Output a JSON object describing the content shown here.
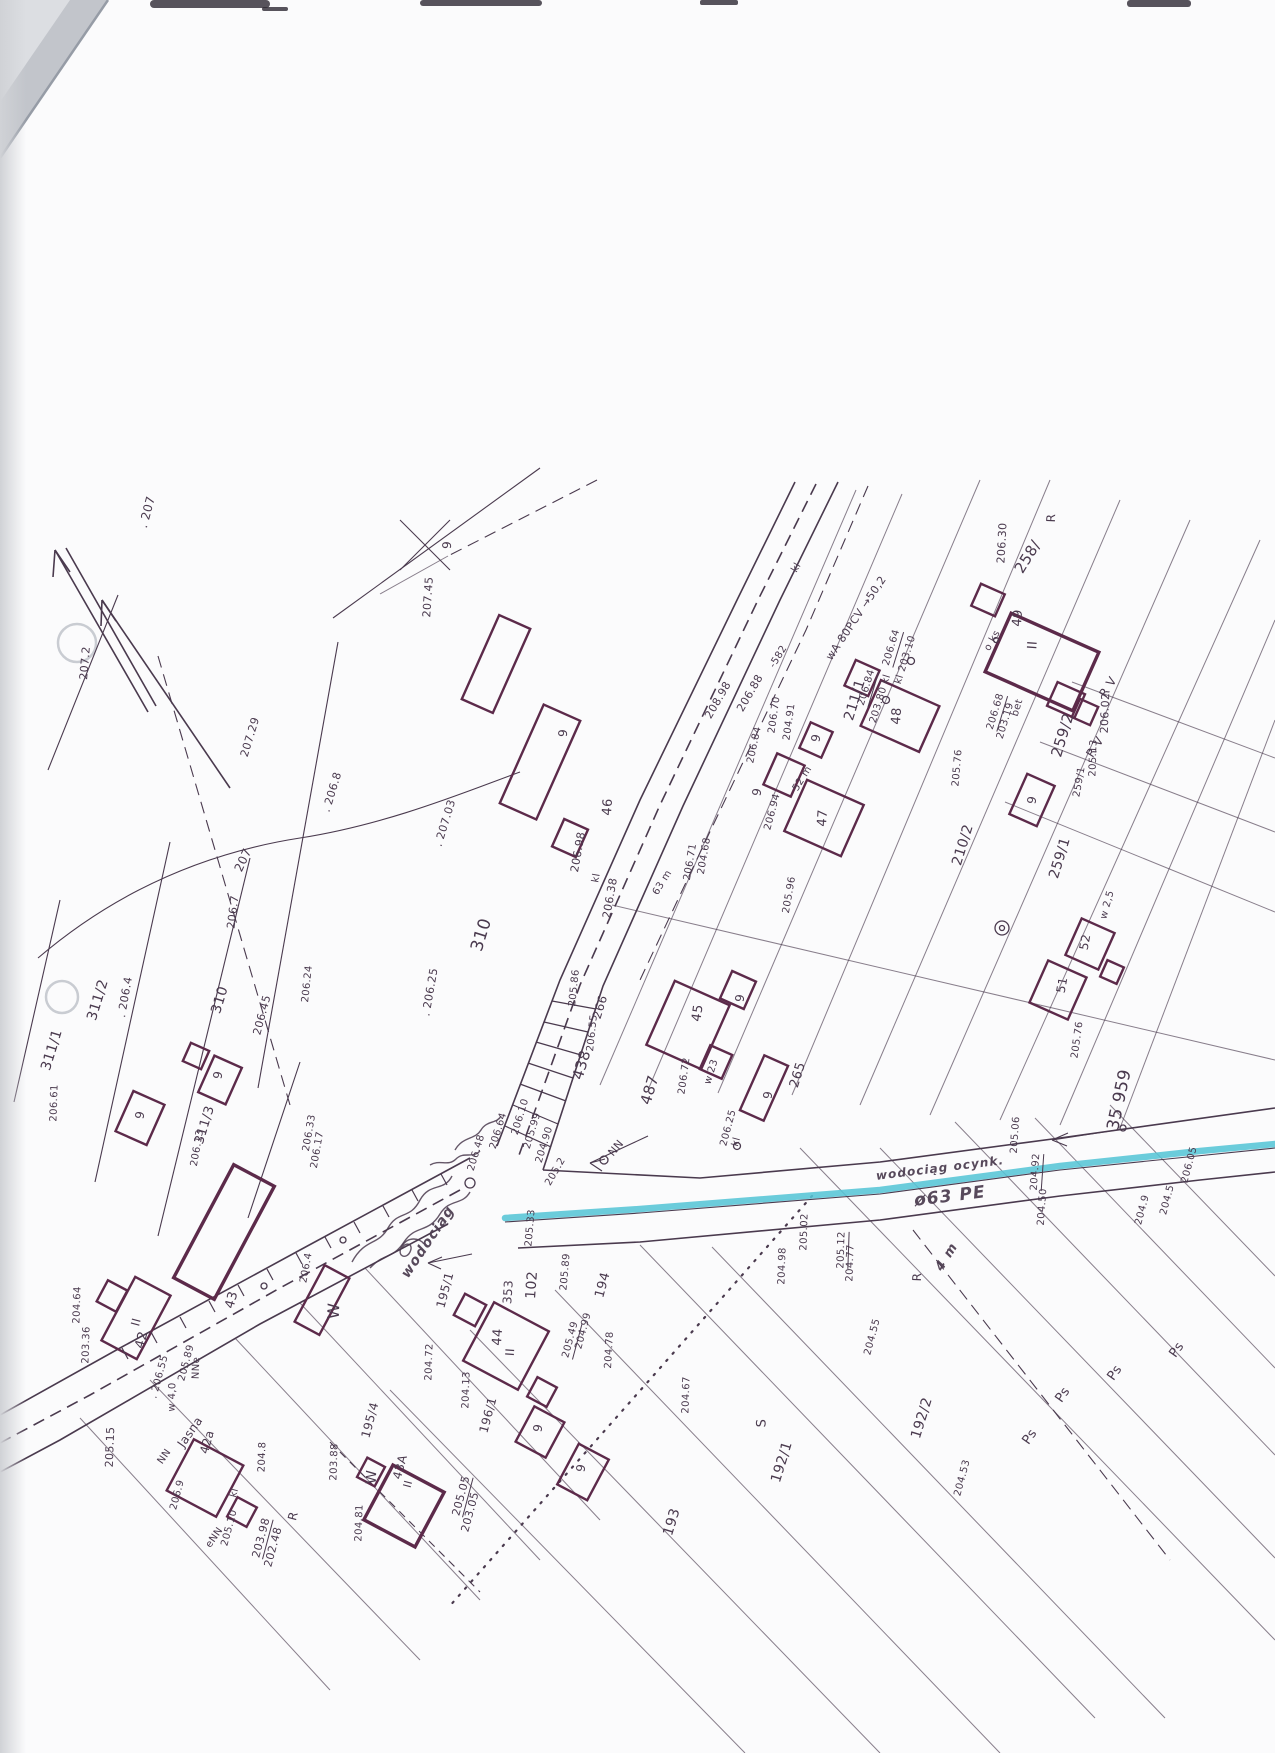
{
  "document": {
    "type": "scanned geodetic cadastral map sheet",
    "street": "Jasna"
  },
  "colors": {
    "paper": "#fbfbfc",
    "ink": "#4a3a4e",
    "ink_faint": "#8a7c90",
    "building": "#5c2a4a",
    "highlight": "#57c5d6",
    "edge_shadow": "#c9ccd1",
    "smudge": "#2e2933"
  },
  "map": {
    "labels": [
      {
        "t": ". 207",
        "x": 147,
        "y": 512,
        "r": -75,
        "s": 12
      },
      {
        "t": "207.2",
        "x": 85,
        "y": 663,
        "r": -85,
        "s": 11
      },
      {
        "t": "207.29",
        "x": 250,
        "y": 737,
        "r": -73,
        "s": 11
      },
      {
        "t": "207",
        "x": 243,
        "y": 860,
        "r": -65,
        "s": 12
      },
      {
        "t": ". 206.8",
        "x": 332,
        "y": 792,
        "r": -73,
        "s": 11
      },
      {
        "t": "206.7",
        "x": 233,
        "y": 912,
        "r": -83,
        "s": 11
      },
      {
        "t": "311/2",
        "x": 98,
        "y": 1000,
        "r": -73,
        "s": 14
      },
      {
        "t": "311/1",
        "x": 52,
        "y": 1050,
        "r": -73,
        "s": 14
      },
      {
        "t": ". 206.4",
        "x": 125,
        "y": 997,
        "r": -80,
        "s": 11
      },
      {
        "t": "310",
        "x": 220,
        "y": 1000,
        "r": -73,
        "s": 14
      },
      {
        "t": "206.45",
        "x": 262,
        "y": 1015,
        "r": -75,
        "s": 11
      },
      {
        "t": "310",
        "x": 482,
        "y": 935,
        "r": -73,
        "s": 17
      },
      {
        "t": ". 207.03",
        "x": 445,
        "y": 823,
        "r": -73,
        "s": 11
      },
      {
        "t": ". 206.25",
        "x": 430,
        "y": 992,
        "r": -80,
        "s": 11
      },
      {
        "t": "206.24",
        "x": 308,
        "y": 984,
        "r": -84,
        "s": 10
      },
      {
        "t": "207.45",
        "x": 428,
        "y": 597,
        "r": -86,
        "s": 11
      },
      {
        "t": "9",
        "x": 447,
        "y": 545,
        "r": -86,
        "s": 12
      },
      {
        "t": "206.98",
        "x": 578,
        "y": 852,
        "r": -80,
        "s": 11
      },
      {
        "t": "kl",
        "x": 597,
        "y": 878,
        "r": -80,
        "s": 10
      },
      {
        "t": "206.38",
        "x": 610,
        "y": 898,
        "r": -80,
        "s": 11
      },
      {
        "t": "9",
        "x": 563,
        "y": 733,
        "r": -86,
        "s": 12
      },
      {
        "t": "46",
        "x": 608,
        "y": 807,
        "r": -86,
        "s": 13
      },
      {
        "t": "208.98",
        "x": 718,
        "y": 700,
        "r": -60,
        "s": 11
      },
      {
        "t": "206.88",
        "x": 750,
        "y": 693,
        "r": -60,
        "s": 11
      },
      {
        "t": "-582",
        "x": 779,
        "y": 657,
        "r": -58,
        "s": 10
      },
      {
        "t": "206.84",
        "x": 755,
        "y": 745,
        "r": -78,
        "s": 10
      },
      {
        "t": "206.70",
        "x": 775,
        "y": 715,
        "r": -82,
        "s": 10
      },
      {
        "t": "204.91",
        "x": 790,
        "y": 722,
        "r": -82,
        "s": 10
      },
      {
        "t": "wA 80PCV →50,2",
        "x": 856,
        "y": 618,
        "r": -56,
        "s": 11
      },
      {
        "t": "kl",
        "x": 797,
        "y": 568,
        "r": -60,
        "s": 10
      },
      {
        "t": "206.94",
        "x": 773,
        "y": 812,
        "r": -75,
        "s": 10
      },
      {
        "t": "52 m",
        "x": 803,
        "y": 779,
        "r": -58,
        "s": 10
      },
      {
        "t": "47",
        "x": 823,
        "y": 818,
        "r": -86,
        "s": 13
      },
      {
        "t": "9",
        "x": 757,
        "y": 792,
        "r": -80,
        "s": 12
      },
      {
        "t": "9",
        "x": 816,
        "y": 738,
        "r": -80,
        "s": 12
      },
      {
        "t": "48",
        "x": 897,
        "y": 716,
        "r": -86,
        "s": 13
      },
      {
        "t": "206.84",
        "x": 868,
        "y": 688,
        "r": -73,
        "s": 10,
        "u": true
      },
      {
        "t": "203.80 kl",
        "x": 881,
        "y": 699,
        "r": -73,
        "s": 10
      },
      {
        "t": "206.64",
        "x": 893,
        "y": 648,
        "r": -73,
        "s": 10,
        "u": true
      },
      {
        "t": "kl 203.10",
        "x": 906,
        "y": 660,
        "r": -73,
        "s": 10
      },
      {
        "t": "o ks",
        "x": 993,
        "y": 641,
        "r": -60,
        "s": 10
      },
      {
        "t": "206.68",
        "x": 997,
        "y": 712,
        "r": -73,
        "s": 10,
        "u": true
      },
      {
        "t": "203.19",
        "x": 1006,
        "y": 721,
        "r": -73,
        "s": 10
      },
      {
        "t": "bet",
        "x": 1018,
        "y": 708,
        "r": -73,
        "s": 10
      },
      {
        "t": "49",
        "x": 1018,
        "y": 618,
        "r": -86,
        "s": 13
      },
      {
        "t": "II",
        "x": 1033,
        "y": 645,
        "r": -86,
        "s": 13
      },
      {
        "t": "258/",
        "x": 1028,
        "y": 557,
        "r": -58,
        "s": 15
      },
      {
        "t": "259/2",
        "x": 1063,
        "y": 735,
        "r": -73,
        "s": 15
      },
      {
        "t": "R V",
        "x": 1108,
        "y": 687,
        "r": -58,
        "s": 12
      },
      {
        "t": "R V",
        "x": 1095,
        "y": 747,
        "r": -58,
        "s": 12
      },
      {
        "t": "206.30",
        "x": 1002,
        "y": 543,
        "r": -87,
        "s": 11
      },
      {
        "t": "R",
        "x": 1051,
        "y": 518,
        "r": -88,
        "s": 12
      },
      {
        "t": "206.02",
        "x": 1105,
        "y": 713,
        "r": -88,
        "s": 11
      },
      {
        "t": "205.13",
        "x": 1094,
        "y": 758,
        "r": -88,
        "s": 10
      },
      {
        "t": "259/1",
        "x": 1080,
        "y": 782,
        "r": -80,
        "s": 10
      },
      {
        "t": "211/1",
        "x": 855,
        "y": 700,
        "r": -73,
        "s": 14
      },
      {
        "t": "210/2",
        "x": 963,
        "y": 845,
        "r": -73,
        "s": 14
      },
      {
        "t": "259/1",
        "x": 1060,
        "y": 858,
        "r": -73,
        "s": 14
      },
      {
        "t": "205.76",
        "x": 958,
        "y": 768,
        "r": -85,
        "s": 10
      },
      {
        "t": "9",
        "x": 1032,
        "y": 800,
        "r": -80,
        "s": 12
      },
      {
        "t": "205.96",
        "x": 790,
        "y": 895,
        "r": -80,
        "s": 10
      },
      {
        "t": "52",
        "x": 1085,
        "y": 942,
        "r": -80,
        "s": 12
      },
      {
        "t": "51",
        "x": 1062,
        "y": 985,
        "r": -80,
        "s": 12
      },
      {
        "t": "w 2,5",
        "x": 1108,
        "y": 905,
        "r": -75,
        "s": 10
      },
      {
        "t": "205.86",
        "x": 575,
        "y": 988,
        "r": -84,
        "s": 10
      },
      {
        "t": "266",
        "x": 600,
        "y": 1007,
        "r": -73,
        "s": 12
      },
      {
        "t": "206.55",
        "x": 593,
        "y": 1033,
        "r": -84,
        "s": 10
      },
      {
        "t": "438",
        "x": 582,
        "y": 1065,
        "r": -73,
        "s": 15
      },
      {
        "t": "487",
        "x": 650,
        "y": 1090,
        "r": -73,
        "s": 15
      },
      {
        "t": "206.72",
        "x": 685,
        "y": 1076,
        "r": -82,
        "s": 10
      },
      {
        "t": "w 23",
        "x": 712,
        "y": 1072,
        "r": -73,
        "s": 10
      },
      {
        "t": "206.25",
        "x": 729,
        "y": 1128,
        "r": -75,
        "s": 10
      },
      {
        "t": "kl",
        "x": 737,
        "y": 1142,
        "r": -75,
        "s": 10
      },
      {
        "t": "265",
        "x": 798,
        "y": 1075,
        "r": -73,
        "s": 13
      },
      {
        "t": "45",
        "x": 698,
        "y": 1013,
        "r": -82,
        "s": 13
      },
      {
        "t": "9",
        "x": 740,
        "y": 998,
        "r": -82,
        "s": 12
      },
      {
        "t": "9",
        "x": 768,
        "y": 1095,
        "r": -82,
        "s": 12
      },
      {
        "t": "63 m",
        "x": 663,
        "y": 883,
        "r": -58,
        "s": 10
      },
      {
        "t": "206.71",
        "x": 691,
        "y": 862,
        "r": -80,
        "s": 10
      },
      {
        "t": "204.68",
        "x": 705,
        "y": 856,
        "r": -80,
        "s": 10
      },
      {
        "t": "206.48",
        "x": 477,
        "y": 1153,
        "r": -73,
        "s": 10
      },
      {
        "t": "206.64",
        "x": 499,
        "y": 1131,
        "r": -73,
        "s": 10
      },
      {
        "t": "206.10",
        "x": 521,
        "y": 1117,
        "r": -73,
        "s": 10
      },
      {
        "t": "205.99",
        "x": 533,
        "y": 1131,
        "r": -73,
        "s": 10
      },
      {
        "t": "204.90",
        "x": 545,
        "y": 1145,
        "r": -73,
        "s": 10
      },
      {
        "t": "205.2",
        "x": 556,
        "y": 1172,
        "r": -60,
        "s": 10
      },
      {
        "t": "NN",
        "x": 616,
        "y": 1148,
        "r": -50,
        "s": 11
      },
      {
        "t": "205.33",
        "x": 531,
        "y": 1228,
        "r": -85,
        "s": 10
      },
      {
        "t": "205.89",
        "x": 566,
        "y": 1272,
        "r": -85,
        "s": 10
      },
      {
        "t": "353",
        "x": 508,
        "y": 1292,
        "r": -86,
        "s": 12
      },
      {
        "t": "102",
        "x": 532,
        "y": 1285,
        "r": -86,
        "s": 14
      },
      {
        "t": "194",
        "x": 603,
        "y": 1285,
        "r": -75,
        "s": 13
      },
      {
        "t": "204.78",
        "x": 610,
        "y": 1350,
        "r": -87,
        "s": 10
      },
      {
        "t": "205.49",
        "x": 572,
        "y": 1340,
        "r": -75,
        "s": 10,
        "u": true
      },
      {
        "t": "204.99",
        "x": 584,
        "y": 1331,
        "r": -75,
        "s": 10
      },
      {
        "t": "44",
        "x": 498,
        "y": 1337,
        "r": -86,
        "s": 13
      },
      {
        "t": "II",
        "x": 510,
        "y": 1352,
        "r": -86,
        "s": 12
      },
      {
        "t": "195/1",
        "x": 445,
        "y": 1290,
        "r": -75,
        "s": 12
      },
      {
        "t": "196/1",
        "x": 488,
        "y": 1415,
        "r": -75,
        "s": 12
      },
      {
        "t": "195/4",
        "x": 370,
        "y": 1420,
        "r": -75,
        "s": 12
      },
      {
        "t": "W",
        "x": 334,
        "y": 1311,
        "r": -88,
        "s": 16
      },
      {
        "t": "W",
        "x": 372,
        "y": 1477,
        "r": -88,
        "s": 14
      },
      {
        "t": "203.88",
        "x": 335,
        "y": 1462,
        "r": -88,
        "s": 10
      },
      {
        "t": "204.8",
        "x": 263,
        "y": 1457,
        "r": -88,
        "s": 10
      },
      {
        "t": "43",
        "x": 232,
        "y": 1300,
        "r": -75,
        "s": 13
      },
      {
        "t": "42",
        "x": 142,
        "y": 1340,
        "r": -75,
        "s": 13
      },
      {
        "t": "II",
        "x": 136,
        "y": 1322,
        "r": -75,
        "s": 12
      },
      {
        "t": "205.89",
        "x": 187,
        "y": 1363,
        "r": -75,
        "s": 10
      },
      {
        "t": ". 206.55",
        "x": 160,
        "y": 1377,
        "r": -75,
        "s": 10
      },
      {
        "t": "Jasna",
        "x": 190,
        "y": 1432,
        "r": -55,
        "s": 12
      },
      {
        "t": "NN",
        "x": 165,
        "y": 1457,
        "r": -55,
        "s": 10
      },
      {
        "t": "eNN",
        "x": 215,
        "y": 1538,
        "r": -55,
        "s": 10
      },
      {
        "t": "NNe",
        "x": 197,
        "y": 1368,
        "r": -88,
        "s": 10
      },
      {
        "t": "w 4,0",
        "x": 173,
        "y": 1397,
        "r": -88,
        "s": 10
      },
      {
        "t": "205.15",
        "x": 110,
        "y": 1447,
        "r": -88,
        "s": 11
      },
      {
        "t": "204.64",
        "x": 78,
        "y": 1305,
        "r": -88,
        "s": 10
      },
      {
        "t": "203.36",
        "x": 87,
        "y": 1345,
        "r": -88,
        "s": 10
      },
      {
        "t": "203.98",
        "x": 262,
        "y": 1538,
        "r": -75,
        "s": 11,
        "u": true
      },
      {
        "t": "202.48",
        "x": 273,
        "y": 1547,
        "r": -75,
        "s": 11
      },
      {
        "t": "kl",
        "x": 235,
        "y": 1493,
        "r": -75,
        "s": 10
      },
      {
        "t": "205.10",
        "x": 230,
        "y": 1528,
        "r": -75,
        "s": 10
      },
      {
        "t": "42a",
        "x": 207,
        "y": 1442,
        "r": -75,
        "s": 12
      },
      {
        "t": "43A",
        "x": 400,
        "y": 1467,
        "r": -75,
        "s": 12
      },
      {
        "t": "II",
        "x": 408,
        "y": 1484,
        "r": -75,
        "s": 11
      },
      {
        "t": "205.05",
        "x": 462,
        "y": 1496,
        "r": -75,
        "s": 11,
        "u": true
      },
      {
        "t": "203.05",
        "x": 470,
        "y": 1512,
        "r": -75,
        "s": 11
      },
      {
        "t": "204.13",
        "x": 467,
        "y": 1390,
        "r": -88,
        "s": 10
      },
      {
        "t": "204.72",
        "x": 430,
        "y": 1362,
        "r": -88,
        "s": 10
      },
      {
        "t": "204.81",
        "x": 360,
        "y": 1523,
        "r": -88,
        "s": 10
      },
      {
        "t": "R",
        "x": 293,
        "y": 1516,
        "r": -75,
        "s": 12
      },
      {
        "t": "9",
        "x": 538,
        "y": 1428,
        "r": -80,
        "s": 12
      },
      {
        "t": "9",
        "x": 581,
        "y": 1468,
        "r": -80,
        "s": 12
      },
      {
        "t": "9",
        "x": 140,
        "y": 1115,
        "r": -80,
        "s": 12
      },
      {
        "t": "9",
        "x": 218,
        "y": 1075,
        "r": -80,
        "s": 12
      },
      {
        "t": "311/3",
        "x": 205,
        "y": 1125,
        "r": -73,
        "s": 13
      },
      {
        "t": "206.61",
        "x": 55,
        "y": 1103,
        "r": -88,
        "s": 10
      },
      {
        "t": "206.33",
        "x": 310,
        "y": 1133,
        "r": -80,
        "s": 10
      },
      {
        "t": "206.17",
        "x": 318,
        "y": 1150,
        "r": -80,
        "s": 10
      },
      {
        "t": "206.13",
        "x": 198,
        "y": 1148,
        "r": -80,
        "s": 10
      },
      {
        "t": "206.4",
        "x": 307,
        "y": 1268,
        "r": -80,
        "s": 10
      },
      {
        "t": "206.9",
        "x": 178,
        "y": 1495,
        "r": -75,
        "s": 10
      },
      {
        "t": "205.02",
        "x": 805,
        "y": 1232,
        "r": -88,
        "s": 10
      },
      {
        "t": "204.98",
        "x": 783,
        "y": 1266,
        "r": -88,
        "s": 10
      },
      {
        "t": "205.12",
        "x": 843,
        "y": 1250,
        "r": -88,
        "s": 10,
        "u": true
      },
      {
        "t": "204.77",
        "x": 851,
        "y": 1263,
        "r": -88,
        "s": 10
      },
      {
        "t": "R",
        "x": 917,
        "y": 1277,
        "r": -88,
        "s": 12
      },
      {
        "t": "4 m",
        "x": 947,
        "y": 1257,
        "r": -58,
        "s": 13,
        "c": "scrawl"
      },
      {
        "t": "204.55",
        "x": 873,
        "y": 1337,
        "r": -75,
        "s": 10
      },
      {
        "t": "204.53",
        "x": 963,
        "y": 1478,
        "r": -75,
        "s": 10
      },
      {
        "t": "S",
        "x": 762,
        "y": 1423,
        "r": -88,
        "s": 13
      },
      {
        "t": "Ps",
        "x": 1115,
        "y": 1373,
        "r": -55,
        "s": 13
      },
      {
        "t": "Ps",
        "x": 1063,
        "y": 1395,
        "r": -55,
        "s": 13
      },
      {
        "t": "Ps",
        "x": 1030,
        "y": 1437,
        "r": -55,
        "s": 13
      },
      {
        "t": "Ps",
        "x": 1177,
        "y": 1350,
        "r": -55,
        "s": 13
      },
      {
        "t": "192/2",
        "x": 922,
        "y": 1418,
        "r": -73,
        "s": 14
      },
      {
        "t": "192/1",
        "x": 782,
        "y": 1462,
        "r": -73,
        "s": 14
      },
      {
        "t": "193",
        "x": 672,
        "y": 1522,
        "r": -73,
        "s": 14
      },
      {
        "t": "204.67",
        "x": 687,
        "y": 1395,
        "r": -88,
        "s": 10
      },
      {
        "t": "wodociąg ocynk.",
        "x": 940,
        "y": 1168,
        "r": -7,
        "s": 12,
        "c": "scrawl"
      },
      {
        "t": "ø63 PE",
        "x": 950,
        "y": 1197,
        "r": -7,
        "s": 17,
        "c": "scrawl"
      },
      {
        "t": "205.06",
        "x": 1016,
        "y": 1135,
        "r": -86,
        "s": 10
      },
      {
        "t": "205.76",
        "x": 1078,
        "y": 1040,
        "r": -82,
        "s": 10
      },
      {
        "t": "204.92",
        "x": 1037,
        "y": 1172,
        "r": -86,
        "s": 10,
        "u": true
      },
      {
        "t": "204.50",
        "x": 1043,
        "y": 1207,
        "r": -86,
        "s": 10
      },
      {
        "t": "204.9",
        "x": 1143,
        "y": 1210,
        "r": -75,
        "s": 10
      },
      {
        "t": "204.5",
        "x": 1168,
        "y": 1200,
        "r": -75,
        "s": 10
      },
      {
        "t": "206.05",
        "x": 1190,
        "y": 1165,
        "r": -75,
        "s": 10
      },
      {
        "t": "35 959",
        "x": 1120,
        "y": 1100,
        "r": -78,
        "s": 17
      },
      {
        "t": "wodociąg",
        "x": 428,
        "y": 1242,
        "r": -56,
        "s": 14,
        "c": "scrawl"
      }
    ]
  }
}
